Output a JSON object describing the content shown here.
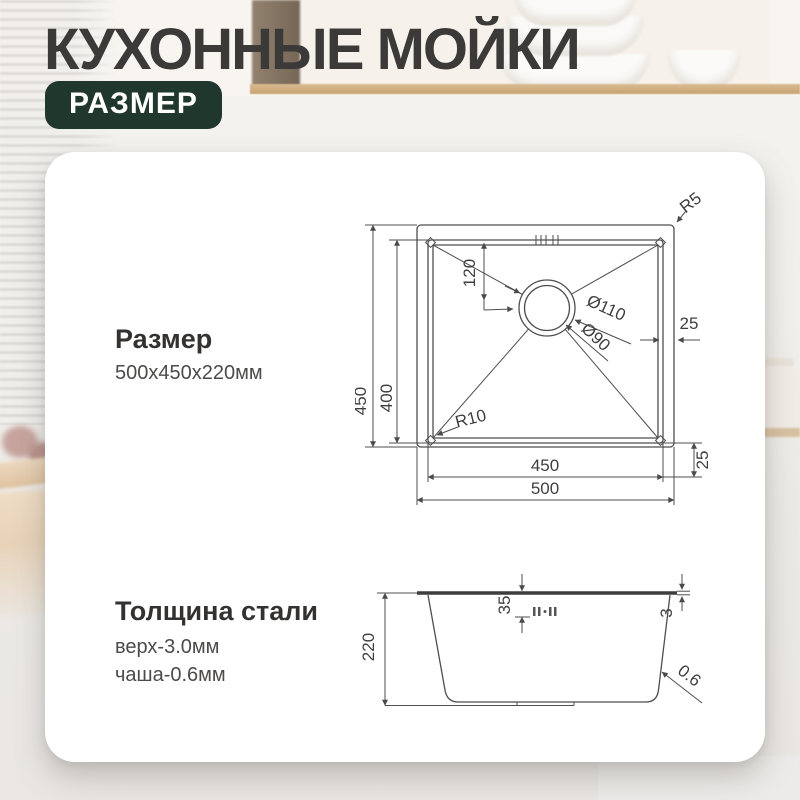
{
  "header": {
    "title": "КУХОННЫЕ МОЙКИ",
    "badge": "РАЗМЕР"
  },
  "sections": {
    "size": {
      "heading": "Размер",
      "value": "500x450x220мм"
    },
    "thickness": {
      "heading": "Толщина стали",
      "top": "верх-3.0мм",
      "bowl": "чаша-0.6мм"
    }
  },
  "top_view": {
    "outer_width_mm": "500",
    "inner_width_mm": "450",
    "outer_depth_mm": "450",
    "inner_depth_mm": "400",
    "drain_offset_mm": "120",
    "rim_side_mm": "25",
    "rim_bottom_mm": "25",
    "drain_outer_d": "Ø110",
    "drain_inner_d": "Ø90",
    "outer_corner_radius": "R5",
    "inner_corner_radius": "R10"
  },
  "side_view": {
    "height_mm": "220",
    "ledge_mm": "35",
    "top_thickness_mm": "3",
    "wall_thickness_mm": "0.6"
  },
  "colors": {
    "badge_bg": "#20372d",
    "title_text": "#3b3a39",
    "drawing_line": "#4e4e4e",
    "card_bg": "#ffffff"
  }
}
